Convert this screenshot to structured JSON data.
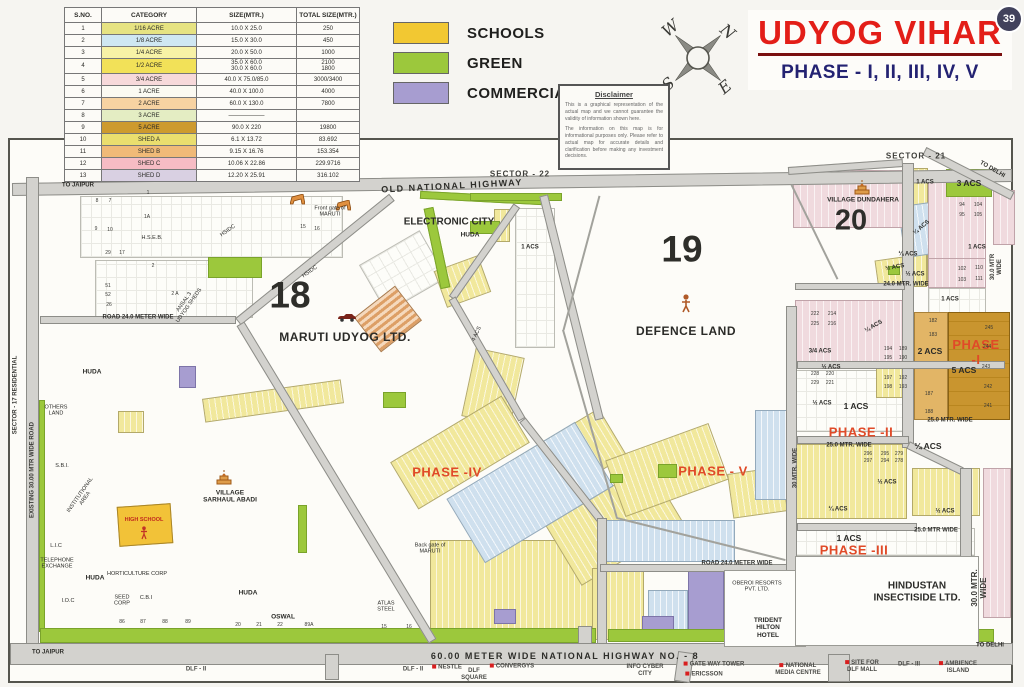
{
  "page": {
    "badge": "39"
  },
  "title": {
    "main": "UDYOG VIHAR",
    "sub": "PHASE - I, II, III, IV, V"
  },
  "legend": {
    "items": [
      {
        "label": "SCHOOLS",
        "color": "#f2c832"
      },
      {
        "label": "GREEN",
        "color": "#9cc83c"
      },
      {
        "label": "COMMERCIAL",
        "color": "#a79dd0"
      }
    ]
  },
  "compass": {
    "w": "W",
    "n": "N",
    "s": "S",
    "e": "E"
  },
  "disclaimer": {
    "title": "Disclaimer",
    "p1": "This is a graphical representation of the actual map and we cannot guarantee the validity of information shown here.",
    "p2": "The information on this map is for informational purposes only. Please refer to actual map for accurate details and clarification before making any investment decisions."
  },
  "table": {
    "headers": [
      "S.NO.",
      "CATEGORY",
      "SIZE(MTR.)",
      "TOTAL SIZE(MTR.)"
    ],
    "rows": [
      {
        "sno": "1",
        "category": "1/16 ACRE",
        "size": "10.0 X 25.0",
        "total": "250",
        "color": "#e6e382"
      },
      {
        "sno": "2",
        "category": "1/8 ACRE",
        "size": "15.0 X 30.0",
        "total": "450",
        "color": "#cfe7f2"
      },
      {
        "sno": "3",
        "category": "1/4 ACRE",
        "size": "20.0 X 50.0",
        "total": "1000",
        "color": "#f7f2a6"
      },
      {
        "sno": "4",
        "category": "1/2 ACRE",
        "size": "35.0 X 60.0\n30.0 X 60.0",
        "total": "2100\n1800",
        "color": "#f2e158"
      },
      {
        "sno": "5",
        "category": "3/4 ACRE",
        "size": "40.0 X 75.0/85.0",
        "total": "3000/3400",
        "color": "#f7d9da"
      },
      {
        "sno": "6",
        "category": "1 ACRE",
        "size": "40.0 X 100.0",
        "total": "4000",
        "color": "#fbfaf2"
      },
      {
        "sno": "7",
        "category": "2 ACRE",
        "size": "60.0 X 130.0",
        "total": "7800",
        "color": "#f7d3a2"
      },
      {
        "sno": "8",
        "category": "3 ACRE",
        "size": "——————",
        "total": "",
        "color": "#e4edc3"
      },
      {
        "sno": "9",
        "category": "5 ACRE",
        "size": "90.0 X 220",
        "total": "19800",
        "color": "#cd9a2e"
      },
      {
        "sno": "10",
        "category": "SHED A",
        "size": "6.1 X 13.72",
        "total": "83.692",
        "color": "#eade6e"
      },
      {
        "sno": "11",
        "category": "SHED B",
        "size": "9.15 X 16.76",
        "total": "153.354",
        "color": "#f0ba78"
      },
      {
        "sno": "12",
        "category": "SHED C",
        "size": "10.06 X 22.86",
        "total": "229.9716",
        "color": "#f6bcc4"
      },
      {
        "sno": "13",
        "category": "SHED D",
        "size": "12.20 X 25.91",
        "total": "316.102",
        "color": "#d9d0e2"
      }
    ]
  },
  "map": {
    "labels": [
      {
        "t": "SECTOR - 22",
        "x": 520,
        "y": 174,
        "c": "sec"
      },
      {
        "t": "SECTOR - 21",
        "x": 916,
        "y": 156,
        "c": "sec"
      },
      {
        "t": "OLD NATIONAL HIGHWAY",
        "x": 452,
        "y": 186,
        "c": "hw",
        "r": -3
      },
      {
        "t": "60.00 METER WIDE NATIONAL HIGHWAY NO. - 8",
        "x": 565,
        "y": 656,
        "c": "hw"
      },
      {
        "t": "TO JAIPUR",
        "x": 78,
        "y": 186,
        "c": "sm"
      },
      {
        "t": "TO DELHI",
        "x": 992,
        "y": 170,
        "c": "sm",
        "r": 30
      },
      {
        "t": "TO JAIPUR",
        "x": 48,
        "y": 653,
        "c": "sm"
      },
      {
        "t": "TO DELHI",
        "x": 990,
        "y": 646,
        "c": "sm"
      },
      {
        "t": "SECTOR - 17 RESIDENTIAL",
        "x": 16,
        "y": 395,
        "c": "rdv",
        "r": -90
      },
      {
        "t": "EXISTING 30.00 MTR WIDE ROAD",
        "x": 33,
        "y": 470,
        "c": "rdv",
        "r": -90
      },
      {
        "t": "18",
        "x": 290,
        "y": 296,
        "c": "bn"
      },
      {
        "t": "19",
        "x": 682,
        "y": 250,
        "c": "bn"
      },
      {
        "t": "20",
        "x": 851,
        "y": 221,
        "c": "bn2"
      },
      {
        "t": "MARUTI UDYOG LTD.",
        "x": 345,
        "y": 338,
        "c": "pl"
      },
      {
        "t": "DEFENCE LAND",
        "x": 686,
        "y": 332,
        "c": "pl"
      },
      {
        "t": "ELECTRONIC CITY",
        "x": 449,
        "y": 222,
        "c": "pl2"
      },
      {
        "t": "HUDA",
        "x": 470,
        "y": 235,
        "c": "tb"
      },
      {
        "t": "VILLAGE DUNDAHERA",
        "x": 863,
        "y": 200,
        "c": "tb"
      },
      {
        "t": "VILLAGE\nSARHAUL ABADI",
        "x": 230,
        "y": 497,
        "c": "tb"
      },
      {
        "t": "HINDUSTAN\nINSECTISIDE LTD.",
        "x": 917,
        "y": 592,
        "c": "pl2"
      },
      {
        "t": "OBEROI RESORTS\nPVT. LTD.",
        "x": 757,
        "y": 587,
        "c": "tn"
      },
      {
        "t": "TRIDENT\nHILTON\nHOTEL",
        "x": 768,
        "y": 628,
        "c": "tb"
      },
      {
        "t": "HIGH SCHOOL",
        "x": 144,
        "y": 520,
        "c": "rt"
      },
      {
        "t": "PHASE -IV",
        "x": 447,
        "y": 473,
        "c": "ph"
      },
      {
        "t": "PHASE - V",
        "x": 713,
        "y": 472,
        "c": "ph"
      },
      {
        "t": "PHASE -I",
        "x": 976,
        "y": 353,
        "c": "ph"
      },
      {
        "t": "PHASE -II",
        "x": 861,
        "y": 433,
        "c": "ph"
      },
      {
        "t": "PHASE -III",
        "x": 854,
        "y": 551,
        "c": "ph"
      },
      {
        "t": "ROAD 24.0 METER WIDE",
        "x": 138,
        "y": 318,
        "c": "rd"
      },
      {
        "t": "ROAD 24.0 METER WIDE",
        "x": 737,
        "y": 564,
        "c": "rd"
      },
      {
        "t": "24.0 MTR. WIDE",
        "x": 906,
        "y": 285,
        "c": "rd"
      },
      {
        "t": "25.0 MTR. WIDE",
        "x": 950,
        "y": 421,
        "c": "rd"
      },
      {
        "t": "25.0 MTR. WIDE",
        "x": 849,
        "y": 446,
        "c": "rd"
      },
      {
        "t": "25.0 MTR WIDE",
        "x": 936,
        "y": 531,
        "c": "rd"
      },
      {
        "t": "30.0 MTR WIDE",
        "x": 997,
        "y": 267,
        "c": "rdv",
        "r": -90
      },
      {
        "t": "30.0 MTR. WIDE",
        "x": 979,
        "y": 588,
        "c": "rdv2",
        "r": -90
      },
      {
        "t": "30 MTR. WIDE",
        "x": 796,
        "y": 468,
        "c": "rdv",
        "r": -90
      },
      {
        "t": "H.S.E.B.",
        "x": 152,
        "y": 238,
        "c": "tn"
      },
      {
        "t": "HSIDC",
        "x": 228,
        "y": 231,
        "c": "tn",
        "r": -35
      },
      {
        "t": "HSIDC",
        "x": 310,
        "y": 272,
        "c": "tn",
        "r": -35
      },
      {
        "t": "ANSAL 3\nUDYOG SHEDS",
        "x": 187,
        "y": 304,
        "c": "tn",
        "r": -55
      },
      {
        "t": "OTHERS\nLAND",
        "x": 56,
        "y": 411,
        "c": "tn"
      },
      {
        "t": "S.B.I.",
        "x": 62,
        "y": 466,
        "c": "tn"
      },
      {
        "t": "INSTITUTIONAL\nAREA",
        "x": 83,
        "y": 497,
        "c": "tn",
        "r": -55
      },
      {
        "t": "HUDA",
        "x": 92,
        "y": 372,
        "c": "tb"
      },
      {
        "t": "HUDA",
        "x": 95,
        "y": 578,
        "c": "tb"
      },
      {
        "t": "HUDA",
        "x": 248,
        "y": 593,
        "c": "tb"
      },
      {
        "t": "I.O.C",
        "x": 68,
        "y": 601,
        "c": "tn"
      },
      {
        "t": "L.I.C",
        "x": 56,
        "y": 546,
        "c": "tn"
      },
      {
        "t": "TELEPHONE\nEXCHANGE",
        "x": 57,
        "y": 564,
        "c": "tn"
      },
      {
        "t": "HORTICULTURE CORP",
        "x": 137,
        "y": 574,
        "c": "tn"
      },
      {
        "t": "SEED\nCORP",
        "x": 122,
        "y": 601,
        "c": "tn"
      },
      {
        "t": "C.B.I",
        "x": 146,
        "y": 598,
        "c": "tn"
      },
      {
        "t": "OSWAL",
        "x": 283,
        "y": 617,
        "c": "tb"
      },
      {
        "t": "ATLAS\nSTEEL",
        "x": 386,
        "y": 607,
        "c": "tn"
      },
      {
        "t": "4 ACS",
        "x": 477,
        "y": 334,
        "c": "tn",
        "r": -65
      },
      {
        "t": "Front gate of\nMARUTI",
        "x": 330,
        "y": 212,
        "c": "tn"
      },
      {
        "t": "Back gate of\nMARUTI",
        "x": 430,
        "y": 549,
        "c": "tn"
      },
      {
        "t": "1 ACS",
        "x": 856,
        "y": 407,
        "c": "acs"
      },
      {
        "t": "1 ACS",
        "x": 849,
        "y": 539,
        "c": "acs"
      },
      {
        "t": "1 ACS",
        "x": 925,
        "y": 183,
        "c": "acs2"
      },
      {
        "t": "3 ACS",
        "x": 969,
        "y": 184,
        "c": "acs"
      },
      {
        "t": "1 ACS",
        "x": 977,
        "y": 248,
        "c": "acs2"
      },
      {
        "t": "1 ACS",
        "x": 950,
        "y": 300,
        "c": "acs2"
      },
      {
        "t": "1 ACS",
        "x": 530,
        "y": 248,
        "c": "acs2"
      },
      {
        "t": "2 ACS",
        "x": 930,
        "y": 352,
        "c": "acs"
      },
      {
        "t": "5 ACS",
        "x": 964,
        "y": 371,
        "c": "acs"
      },
      {
        "t": "½ ACS",
        "x": 915,
        "y": 275,
        "c": "acs2"
      },
      {
        "t": "¼ ACS",
        "x": 908,
        "y": 255,
        "c": "acs2"
      },
      {
        "t": "3/4 ACS",
        "x": 820,
        "y": 352,
        "c": "acs2"
      },
      {
        "t": "¼ ACS",
        "x": 874,
        "y": 327,
        "c": "acs2",
        "r": -30
      },
      {
        "t": "½ ACS",
        "x": 831,
        "y": 368,
        "c": "acs2"
      },
      {
        "t": "½ ACS",
        "x": 822,
        "y": 404,
        "c": "acs2"
      },
      {
        "t": "¼ ACS",
        "x": 928,
        "y": 447,
        "c": "acs"
      },
      {
        "t": "¼ ACS",
        "x": 838,
        "y": 510,
        "c": "acs2"
      },
      {
        "t": "½ ACS",
        "x": 887,
        "y": 483,
        "c": "acs2"
      },
      {
        "t": "½ ACS",
        "x": 945,
        "y": 512,
        "c": "acs2"
      },
      {
        "t": "¼ ACS",
        "x": 922,
        "y": 228,
        "c": "acs2",
        "r": -40
      },
      {
        "t": "½ ACS",
        "x": 895,
        "y": 268,
        "c": "acs2",
        "r": -10
      }
    ],
    "plots": [
      [
        "94",
        962,
        206
      ],
      [
        "104",
        978,
        206
      ],
      [
        "95",
        962,
        216
      ],
      [
        "105",
        978,
        216
      ],
      [
        "102",
        962,
        270
      ],
      [
        "110",
        979,
        269
      ],
      [
        "103",
        962,
        281
      ],
      [
        "111",
        979,
        280
      ],
      [
        "245",
        989,
        329
      ],
      [
        "244",
        987,
        348
      ],
      [
        "243",
        986,
        368
      ],
      [
        "242",
        988,
        388
      ],
      [
        "241",
        988,
        407
      ],
      [
        "182",
        933,
        322
      ],
      [
        "183",
        933,
        336
      ],
      [
        "187",
        929,
        395
      ],
      [
        "188",
        929,
        413
      ],
      [
        "222",
        815,
        315
      ],
      [
        "214",
        832,
        315
      ],
      [
        "225",
        815,
        325
      ],
      [
        "216",
        832,
        325
      ],
      [
        "228",
        815,
        375
      ],
      [
        "220",
        830,
        375
      ],
      [
        "229",
        815,
        384
      ],
      [
        "221",
        830,
        384
      ],
      [
        "194",
        888,
        350
      ],
      [
        "189",
        903,
        350
      ],
      [
        "195",
        888,
        359
      ],
      [
        "190",
        903,
        359
      ],
      [
        "197",
        888,
        379
      ],
      [
        "192",
        903,
        379
      ],
      [
        "198",
        888,
        388
      ],
      [
        "193",
        903,
        388
      ],
      [
        "296",
        868,
        455
      ],
      [
        "295",
        885,
        455
      ],
      [
        "279",
        899,
        455
      ],
      [
        "297",
        868,
        462
      ],
      [
        "294",
        885,
        462
      ],
      [
        "278",
        899,
        462
      ],
      [
        "20",
        238,
        626
      ],
      [
        "21",
        259,
        626
      ],
      [
        "22",
        280,
        626
      ],
      [
        "86",
        122,
        623
      ],
      [
        "87",
        143,
        623
      ],
      [
        "88",
        165,
        623
      ],
      [
        "89",
        188,
        623
      ],
      [
        "15",
        384,
        628
      ],
      [
        "16",
        409,
        628
      ],
      [
        "89A",
        309,
        626
      ],
      [
        "29",
        108,
        254
      ],
      [
        "17",
        122,
        254
      ],
      [
        "51",
        108,
        287
      ],
      [
        "52",
        108,
        296
      ],
      [
        "26",
        109,
        306
      ],
      [
        "1",
        148,
        194
      ],
      [
        "1A",
        147,
        218
      ],
      [
        "2",
        153,
        267
      ],
      [
        "2 A",
        175,
        295
      ],
      [
        "8",
        97,
        202
      ],
      [
        "7",
        110,
        202
      ],
      [
        "9",
        96,
        230
      ],
      [
        "10",
        110,
        231
      ],
      [
        "15",
        303,
        228
      ],
      [
        "16",
        317,
        230
      ]
    ]
  },
  "landmarks": [
    {
      "t": "DLF - II",
      "x": 196,
      "y": 670
    },
    {
      "t": "DLF - II",
      "x": 413,
      "y": 670
    },
    {
      "t": "NESTLE",
      "x": 447,
      "y": 668,
      "d": 1
    },
    {
      "t": "DLF\nSQUARE",
      "x": 474,
      "y": 675
    },
    {
      "t": "CONVERGYS",
      "x": 512,
      "y": 667,
      "d": 1
    },
    {
      "t": "INFO CYBER\nCITY",
      "x": 645,
      "y": 671
    },
    {
      "t": "GATE WAY TOWER",
      "x": 714,
      "y": 665,
      "d": 1
    },
    {
      "t": "ERICSSON",
      "x": 704,
      "y": 675,
      "d": 1
    },
    {
      "t": "NATIONAL\nMEDIA CENTRE",
      "x": 798,
      "y": 670,
      "d": 1
    },
    {
      "t": "SITE FOR\nDLF MALL",
      "x": 862,
      "y": 667,
      "d": 1
    },
    {
      "t": "DLF - III",
      "x": 909,
      "y": 665
    },
    {
      "t": "AMBIENCE\nISLAND",
      "x": 958,
      "y": 668,
      "d": 1
    }
  ]
}
